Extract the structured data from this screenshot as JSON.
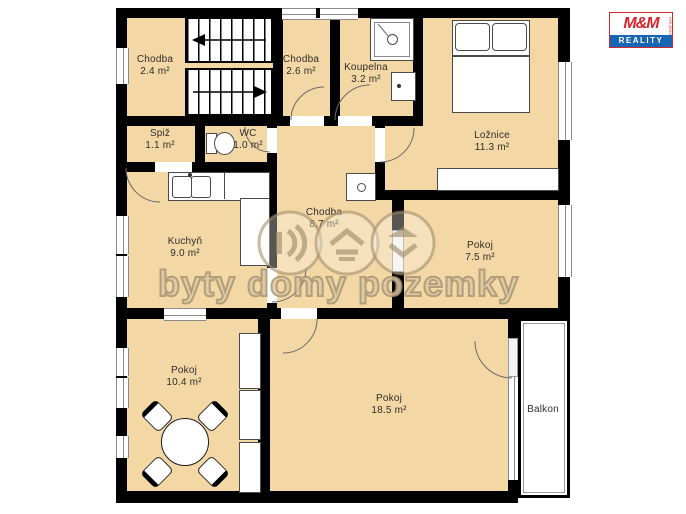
{
  "floorplan": {
    "title": "Apartment floor plan",
    "rooms": [
      {
        "id": "chodba-2-4",
        "name": "Chodba",
        "area": "2.4 m²"
      },
      {
        "id": "chodba-2-6",
        "name": "Chodba",
        "area": "2.6 m²"
      },
      {
        "id": "koupelna",
        "name": "Koupelna",
        "area": "3.2 m²"
      },
      {
        "id": "loznice",
        "name": "Ložnice",
        "area": "11.3 m²"
      },
      {
        "id": "spiz",
        "name": "Spiž",
        "area": "1.1 m²"
      },
      {
        "id": "wc",
        "name": "WC",
        "area": "1.0 m²"
      },
      {
        "id": "kuchyn",
        "name": "Kuchyň",
        "area": "9.0 m²"
      },
      {
        "id": "chodba-8-7",
        "name": "Chodba",
        "area": "8.7 m²"
      },
      {
        "id": "pokoj-7-5",
        "name": "Pokoj",
        "area": "7.5 m²"
      },
      {
        "id": "pokoj-10-4",
        "name": "Pokoj",
        "area": "10.4 m²"
      },
      {
        "id": "pokoj-18-5",
        "name": "Pokoj",
        "area": "18.5 m²"
      },
      {
        "id": "balkon",
        "name": "Balkon",
        "area": ""
      }
    ],
    "furniture": [
      "stairs",
      "bed",
      "wardrobe",
      "shower",
      "washing-machine",
      "toilet",
      "kitchen-sink",
      "kitchen-counter",
      "water-heater",
      "dining-table",
      "chairs",
      "storage-units"
    ],
    "watermark": {
      "text": "byty domy pozemky",
      "icons": [
        "sound-waves-icon",
        "house-icon",
        "house-chevron-icon"
      ]
    },
    "logo": {
      "line1": "M&M",
      "line2": "REALITY",
      "line3": "HOLDING"
    },
    "colors": {
      "room_fill": "#f3d7a4",
      "wall": "#000000",
      "logo_red": "#d8232a",
      "logo_blue": "#1766b3",
      "watermark": "#b89f78"
    }
  }
}
